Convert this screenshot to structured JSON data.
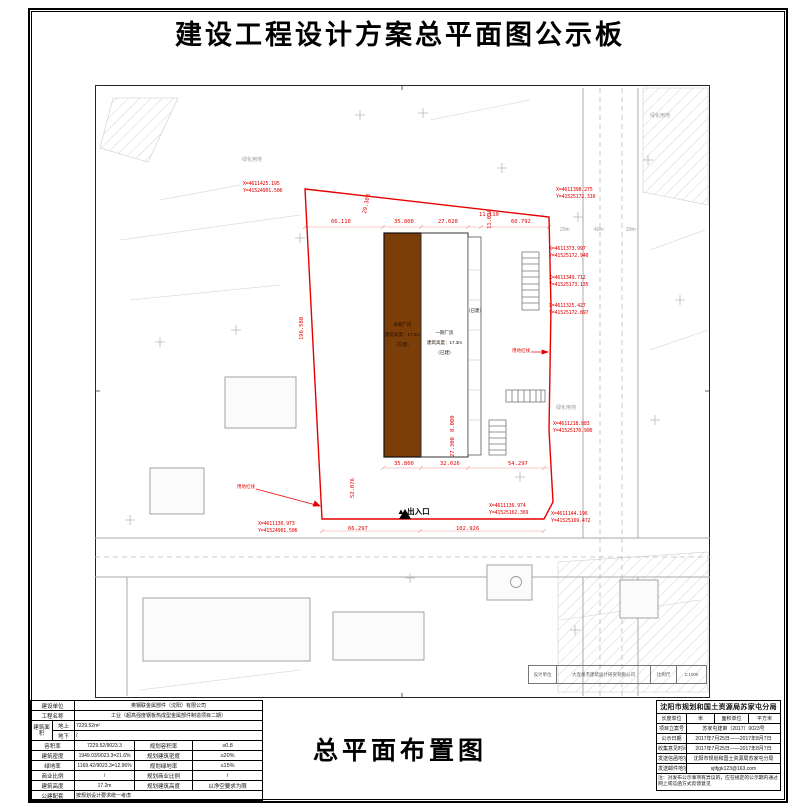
{
  "sheet": {
    "title": "建设工程设计方案总平面图公示板",
    "bottom_title": "总平面布置图"
  },
  "titleblock": {
    "design_label": "设计单位",
    "design_value": "大连易杰建筑设计研究有限公司",
    "scale_label": "比例尺",
    "scale_value": "1:1000"
  },
  "colors": {
    "boundary_red": "#e60000",
    "building_brown": "#7c3e08"
  },
  "drawing": {
    "coords": [
      {
        "name": "coord-top-left",
        "x": 243,
        "y": 181,
        "lines": [
          "X=4611425.195",
          "Y=41524901.506"
        ]
      },
      {
        "name": "coord-top-right",
        "x": 556,
        "y": 187,
        "lines": [
          "X=4611398.275",
          "Y=41525172.310"
        ]
      },
      {
        "name": "coord-right-1",
        "x": 549,
        "y": 246,
        "lines": [
          "X=4611373.997",
          "Y=41525172.940"
        ]
      },
      {
        "name": "coord-right-2",
        "x": 549,
        "y": 275,
        "lines": [
          "X=4611349.712",
          "Y=41525173.135"
        ]
      },
      {
        "name": "coord-right-3",
        "x": 549,
        "y": 303,
        "lines": [
          "X=4611325.427",
          "Y=41525172.897"
        ]
      },
      {
        "name": "coord-right-4",
        "x": 553,
        "y": 421,
        "lines": [
          "X=4611218.883",
          "Y=41525170.900"
        ]
      },
      {
        "name": "coord-bottom-right",
        "x": 551,
        "y": 511,
        "lines": [
          "X=4611144.196",
          "Y=41525169.472"
        ]
      },
      {
        "name": "coord-bottom-mid",
        "x": 489,
        "y": 503,
        "lines": [
          "X=4611136.974",
          "Y=41525162.369"
        ]
      },
      {
        "name": "coord-bottom-left",
        "x": 258,
        "y": 521,
        "lines": [
          "X=4611136.973",
          "Y=41524961.506"
        ]
      }
    ],
    "dims": [
      {
        "x": 331,
        "y": 219,
        "text": "66.110"
      },
      {
        "x": 394,
        "y": 219,
        "text": "35.800"
      },
      {
        "x": 438,
        "y": 219,
        "text": "27.020"
      },
      {
        "x": 479,
        "y": 212,
        "text": "11.110"
      },
      {
        "x": 511,
        "y": 219,
        "text": "60.792"
      },
      {
        "x": 362,
        "y": 213,
        "text": "29.308",
        "rot": -78
      },
      {
        "x": 299,
        "y": 340,
        "text": "196.580",
        "rot": -90
      },
      {
        "x": 487,
        "y": 229,
        "text": "11.090",
        "rot": -90
      },
      {
        "x": 394,
        "y": 461,
        "text": "35.800"
      },
      {
        "x": 440,
        "y": 461,
        "text": "32.026"
      },
      {
        "x": 508,
        "y": 461,
        "text": "54.297"
      },
      {
        "x": 350,
        "y": 498,
        "text": "52.076",
        "rot": -90
      },
      {
        "x": 450,
        "y": 457,
        "text": "27.300",
        "rot": -90
      },
      {
        "x": 450,
        "y": 432,
        "text": "8.080",
        "rot": -90
      },
      {
        "x": 348,
        "y": 526,
        "text": "66.297"
      },
      {
        "x": 456,
        "y": 526,
        "text": "102.926"
      }
    ],
    "small_labels": [
      {
        "x": 650,
        "y": 112,
        "text": "绿化用地",
        "cls": "glabel"
      },
      {
        "x": 556,
        "y": 404,
        "text": "绿化用地",
        "cls": "glabel"
      },
      {
        "x": 242,
        "y": 156,
        "text": "绿化用地",
        "cls": "glabel"
      },
      {
        "x": 560,
        "y": 227,
        "text": "20m",
        "cls": "glabel"
      },
      {
        "x": 594,
        "y": 227,
        "text": "40m",
        "cls": "glabel"
      },
      {
        "x": 626,
        "y": 227,
        "text": "20m",
        "cls": "glabel"
      },
      {
        "x": 512,
        "y": 348,
        "text": "用地红线",
        "cls": "rlabel"
      },
      {
        "x": 237,
        "y": 484,
        "text": "用地红线",
        "cls": "rlabel"
      }
    ],
    "building_labels": [
      {
        "name": "building-current-label",
        "x": 384,
        "y": 320,
        "w": 37,
        "lines": [
          "本期厂房",
          "建筑高度：17.2m",
          "（在建）"
        ]
      },
      {
        "name": "building-phase1-label",
        "x": 421,
        "y": 328,
        "w": 47,
        "lines": [
          "一期厂房",
          "建筑高度：17.3m",
          "（已建）"
        ]
      },
      {
        "name": "annex-label",
        "x": 466,
        "y": 306,
        "w": 17,
        "lines": [
          "（已建）"
        ]
      }
    ],
    "entrance": {
      "icon": "▲",
      "label": "出入口",
      "x": 397,
      "y": 506
    }
  },
  "left_table": {
    "owner_label": "建设单位",
    "owner_value": "奥钢联金属部件（沈阳）有限公司",
    "project_label": "工程名称",
    "project_value": "工业（超高强度钢板热成型金属部件制造项目二期）",
    "area_label": "建筑面积",
    "area_above_label": "地上",
    "area_above_value": "7229.52m²",
    "area_below_label": "地下",
    "area_below_value": "/",
    "far_label": "容积率",
    "far_value": "7229.52/9023.3",
    "far_plan_label": "规划容积率",
    "far_plan_value": "≥0.8",
    "density_label": "建筑密度",
    "density_value": "1949.03/9023.3=21.6%",
    "density_plan_label": "规划建筑密度",
    "density_plan_value": "≥20%",
    "green_label": "绿地率",
    "green_value": "1169.42/9023.3=12.96%",
    "green_plan_label": "规划绿地率",
    "green_plan_value": "≤15%",
    "commercial_label": "商业比例",
    "commercial_value": "/",
    "commercial_plan_label": "规划商业比例",
    "commercial_plan_value": "/",
    "height_label": "建筑高度",
    "height_value": "17.2m",
    "height_plan_label": "规划建筑高度",
    "height_plan_value": "以净空要求为限",
    "public_label": "公建配套",
    "public_value": "按规划设计要求统一考虑"
  },
  "right_table": {
    "header": "沈阳市规划和国土资源局苏家屯分局",
    "unit_len_label": "长度单位",
    "unit_len_value": "米",
    "unit_area_label": "面积单位",
    "unit_area_value": "平方米",
    "case_label": "项目立案号",
    "case_value": "苏家屯建审（2017）0023号",
    "publish_label": "公示日期",
    "publish_value": "2017年7月25日——2017年8月7日",
    "collect_label": "收集意见时间",
    "collect_value": "2017年7月25日——2017年8月7日",
    "mail_label": "发送信函地址",
    "mail_value": "沈阳市规划和国土资源局苏家屯分局",
    "email_label": "发送邮件地址",
    "email_value": "sjtfjgk123@163.com",
    "note": "注：对发布公示事项有异议的，应在规定的公示期内通过网上或信函方式反馈意见"
  }
}
